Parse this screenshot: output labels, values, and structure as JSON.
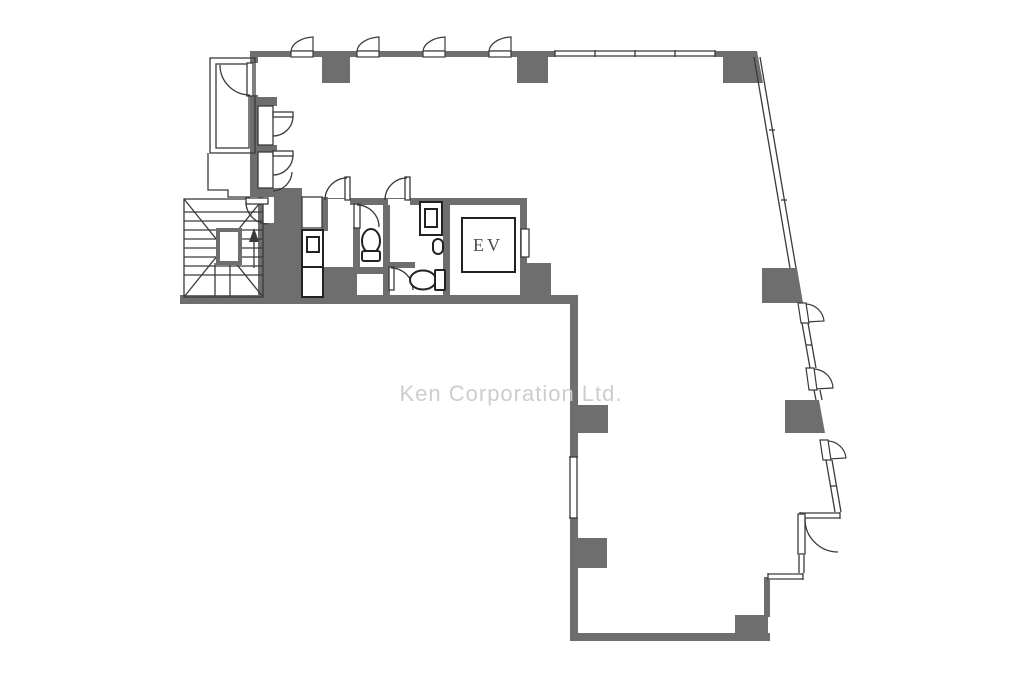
{
  "title": "Office floor plan",
  "labels": {
    "elevator": "EV",
    "watermark": "Ken Corporation Ltd."
  },
  "colors": {
    "wall": "#6e6e6e",
    "line": "#3a3a3a",
    "fixture": "#222222",
    "landing": "#6e6e6e",
    "watermark": "#cdcdcd",
    "background": "#ffffff",
    "ev_text": "#4a4a4a"
  }
}
